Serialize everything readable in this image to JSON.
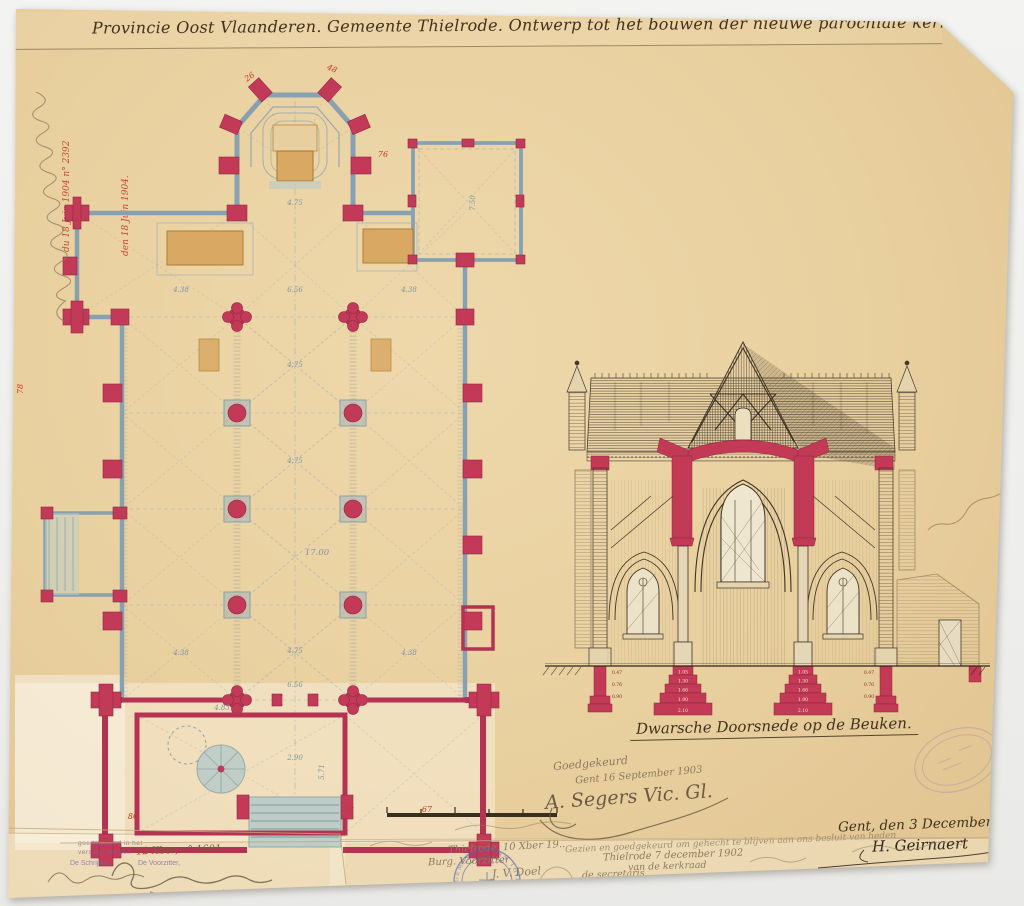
{
  "colors": {
    "paper": "#e8cf9e",
    "ink": "#41321d",
    "wall_red": "#c23a57",
    "outline_blue": "#88a1b1",
    "altar_tan": "#d9a963",
    "steps_blue": "#bccdc9",
    "pencil": "#8d7b60",
    "stamp_purple": "#7b63a0",
    "stamp_blue": "#4f63ab",
    "red_ink": "#c03a28"
  },
  "title": "Provincie Oost Vlaanderen. Gemeente Thielrode. Ontwerp tot het bouwen der nieuwe parochiale kerk. Schaal 1c per m.",
  "plan": {
    "dims": [
      "4.75",
      "6.56",
      "4.38",
      "4.38",
      "7.50",
      "4.75",
      "4.75",
      "17.00",
      "4.75",
      "4.38",
      "4.38",
      "6.56",
      "2.90",
      "5.71",
      "4.83"
    ],
    "red_marks": [
      "26",
      "48",
      "76",
      "78",
      "86",
      "76",
      "67"
    ]
  },
  "section": {
    "caption": "Dwarsche Doorsnede op de Beuken.",
    "foundation_inner": [
      "1.05",
      "1.30",
      "1.66",
      "1.90",
      "2.10"
    ],
    "foundation_outer": [
      "0.47",
      "0.76",
      "0.90"
    ]
  },
  "stamps": {
    "ministry_line1": "VU PAR NOUS MINISTRE DE LA JUSTICE",
    "ministry_line2": "pour être annexé à l'arrêté royal",
    "ministry_red1": "du 18 Juin 1904 n° 2392",
    "ministry_red2": "den 18 Juin 1904.",
    "municipal_circle": "GEMEENTE VAN THIELRODE",
    "council_line1": "goedgekeurd in het",
    "council_line2": "verslag van den",
    "council_insert": "12 Xber, n° 1601",
    "council_clerk": "De Schrijver,",
    "council_chair": "De Voorzitter,"
  },
  "approvals": {
    "pencil_line1": "Goedgekeurd",
    "pencil_line2": "Gent 16 September 1903",
    "vicar_sig": "A. Segers Vic. Gl.",
    "date_line": "Gent, den 3 December 1902.",
    "architect_sig": "H. Geirnaert",
    "council_left_1": "Thielrode, 10 Xber 19..",
    "council_left_2": "Burg. Voorzitter",
    "council_left_3": "J. V. Doel",
    "church_right_1": "Gezien en goedgekeurd om gehecht te blijven aan ons besluit van heden",
    "church_right_2": "Thielrode 7 december 1902",
    "church_right_3": "van de kerkraad",
    "church_right_4": "de secretaris",
    "church_right_5": "F. van de Velde"
  }
}
